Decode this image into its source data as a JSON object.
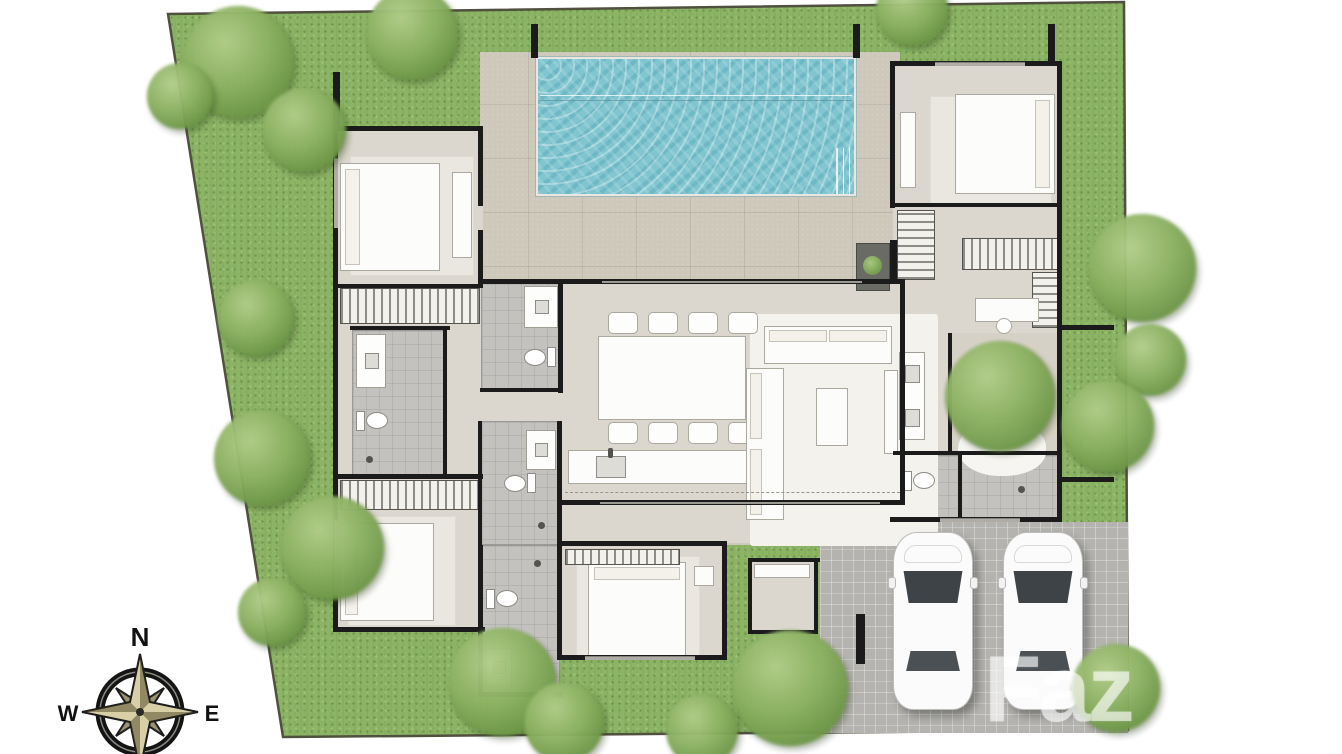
{
  "plan": {
    "title": "Villa site plan with pool, garden and carport",
    "watermark": "Faz"
  },
  "compass": {
    "north": "N",
    "west": "W",
    "east": "E"
  },
  "colors": {
    "grass": "#8cb465",
    "site_border": "#50503f",
    "pool_water": "#80c5d0",
    "terrace_pavers": "#cec8bb",
    "interior_floor": "#dbd7ce",
    "bath_tile": "#c3c2bf",
    "carport_pavers": "#b4b3af",
    "wall": "#1b1b1b",
    "tree_foliage": "#7fa955",
    "compass_star": "#d8cfa6",
    "car_body": "#fbfbfb"
  }
}
